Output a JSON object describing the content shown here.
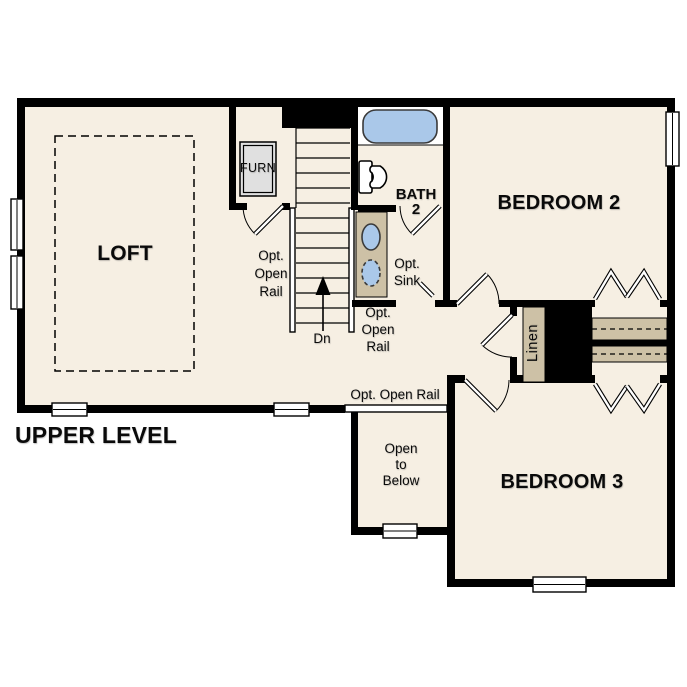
{
  "plan_title": "UPPER LEVEL",
  "rooms": {
    "loft": {
      "label": "LOFT"
    },
    "bath": {
      "label": "BATH\n2"
    },
    "bedroom2": {
      "label": "BEDROOM 2"
    },
    "bedroom3": {
      "label": "BEDROOM 3"
    },
    "linen_closet": {
      "label": "Linen"
    },
    "furnace_closet": {
      "label": "FURN"
    },
    "open_to_below": {
      "label": "Open\nto\nBelow"
    }
  },
  "annotations": {
    "opt_open_rail_stairs_left": "Opt.\nOpen\nRail",
    "opt_open_rail_stairs_right": "Opt.\nOpen\nRail",
    "opt_open_rail_loft_edge": "Opt. Open Rail",
    "opt_sink": "Opt.\nSink",
    "stairs_direction": "Dn"
  },
  "icons": {
    "bathtub": "bathtub-icon",
    "toilet": "toilet-icon",
    "sink": "sink-icon",
    "optional_sink": "optional-sink-icon",
    "furnace": "furnace-icon",
    "stair_arrow": "stair-direction-arrow-icon"
  },
  "colors": {
    "floor": "#f6efe3",
    "wall": "#000000",
    "paper": "#ffffff",
    "water_blue": "#aac8e9",
    "casework_tan": "#cdc1a6",
    "furnace_gray": "#e0e0e0"
  }
}
